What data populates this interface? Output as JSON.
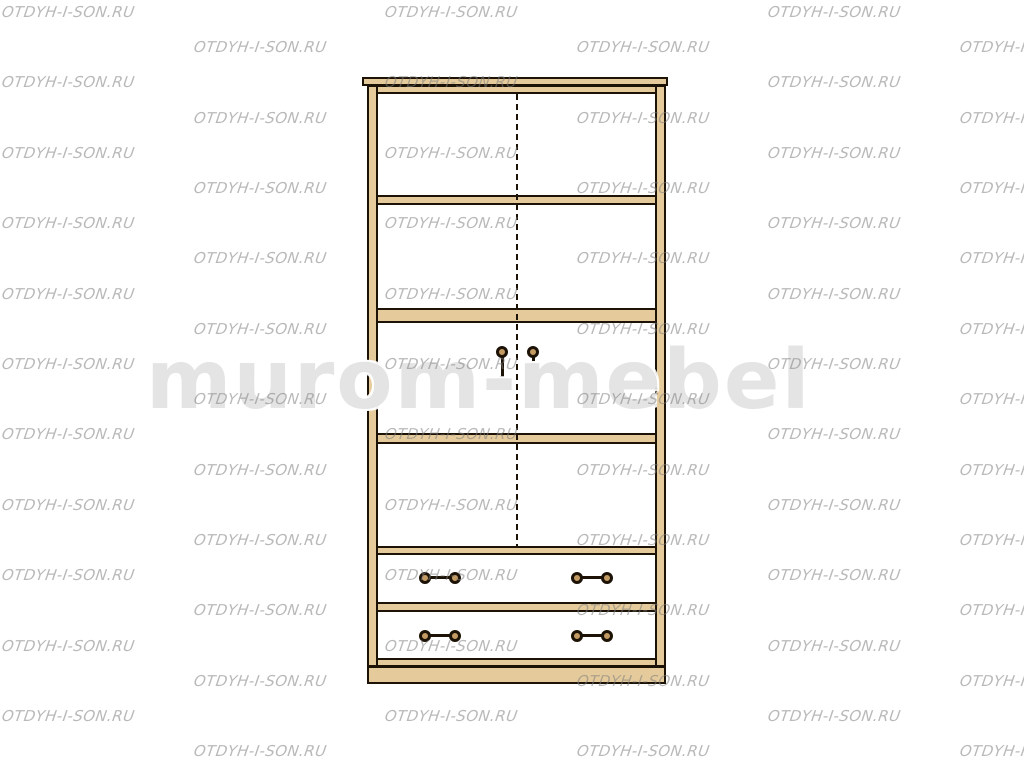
{
  "page": {
    "subject": "Front-view line drawing of a two-door wardrobe with shelves and two drawers"
  },
  "watermark": {
    "text": "OTDYH-I-SON.RU",
    "color": "rgba(128,128,128,0.55)",
    "grid": {
      "rows": 22,
      "cols": 3,
      "row_spacing_px": 35.2,
      "col_spacing_px": 383,
      "start_y_px": 3,
      "even_row_x_px": 2,
      "odd_row_x_px": 194
    }
  },
  "brand_watermark": {
    "text": "murom-mebel",
    "color": "rgba(170,170,170,0.32)"
  },
  "cabinet": {
    "wood_color": "#e5cb9b",
    "outline_color": "#1c1206",
    "knob_color": "#c49c63",
    "doors": 2,
    "drawers": 2,
    "shelf_sections": 4,
    "door_handles": 2,
    "drawer_handles": 4
  }
}
